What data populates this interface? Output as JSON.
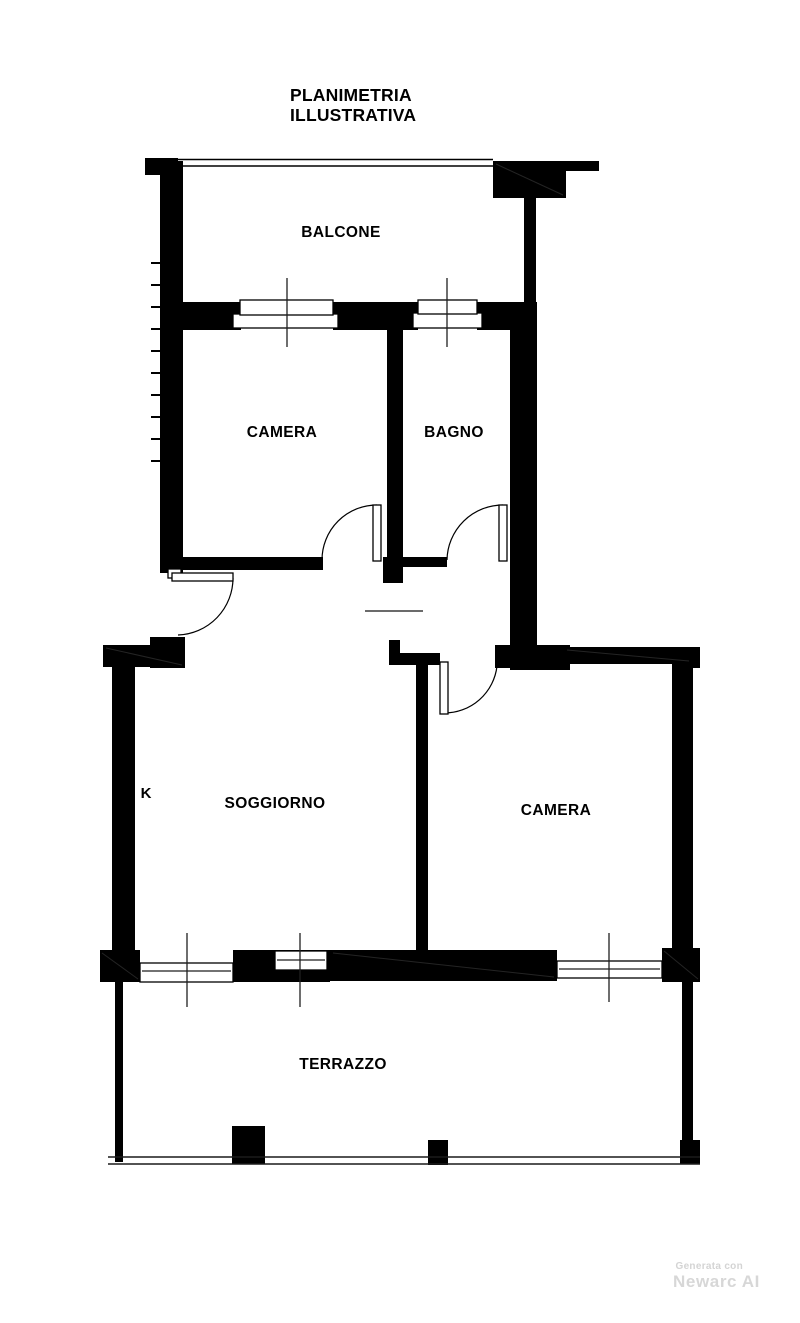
{
  "title": {
    "line1": "PLANIMETRIA",
    "line2": "ILLUSTRATIVA"
  },
  "rooms": {
    "balcone": {
      "label": "BALCONE"
    },
    "camera_upper": {
      "label": "CAMERA"
    },
    "bagno": {
      "label": "BAGNO"
    },
    "kitchen": {
      "label": "K"
    },
    "soggiorno": {
      "label": "SOGGIORNO"
    },
    "camera_lower": {
      "label": "CAMERA"
    },
    "terrazzo": {
      "label": "TERRAZZO"
    }
  },
  "watermark": {
    "line1": "Generata con",
    "line2": "Newarc AI"
  },
  "colors": {
    "ink": "#000000",
    "paper": "#ffffff",
    "watermark": "#d7d7d7"
  }
}
